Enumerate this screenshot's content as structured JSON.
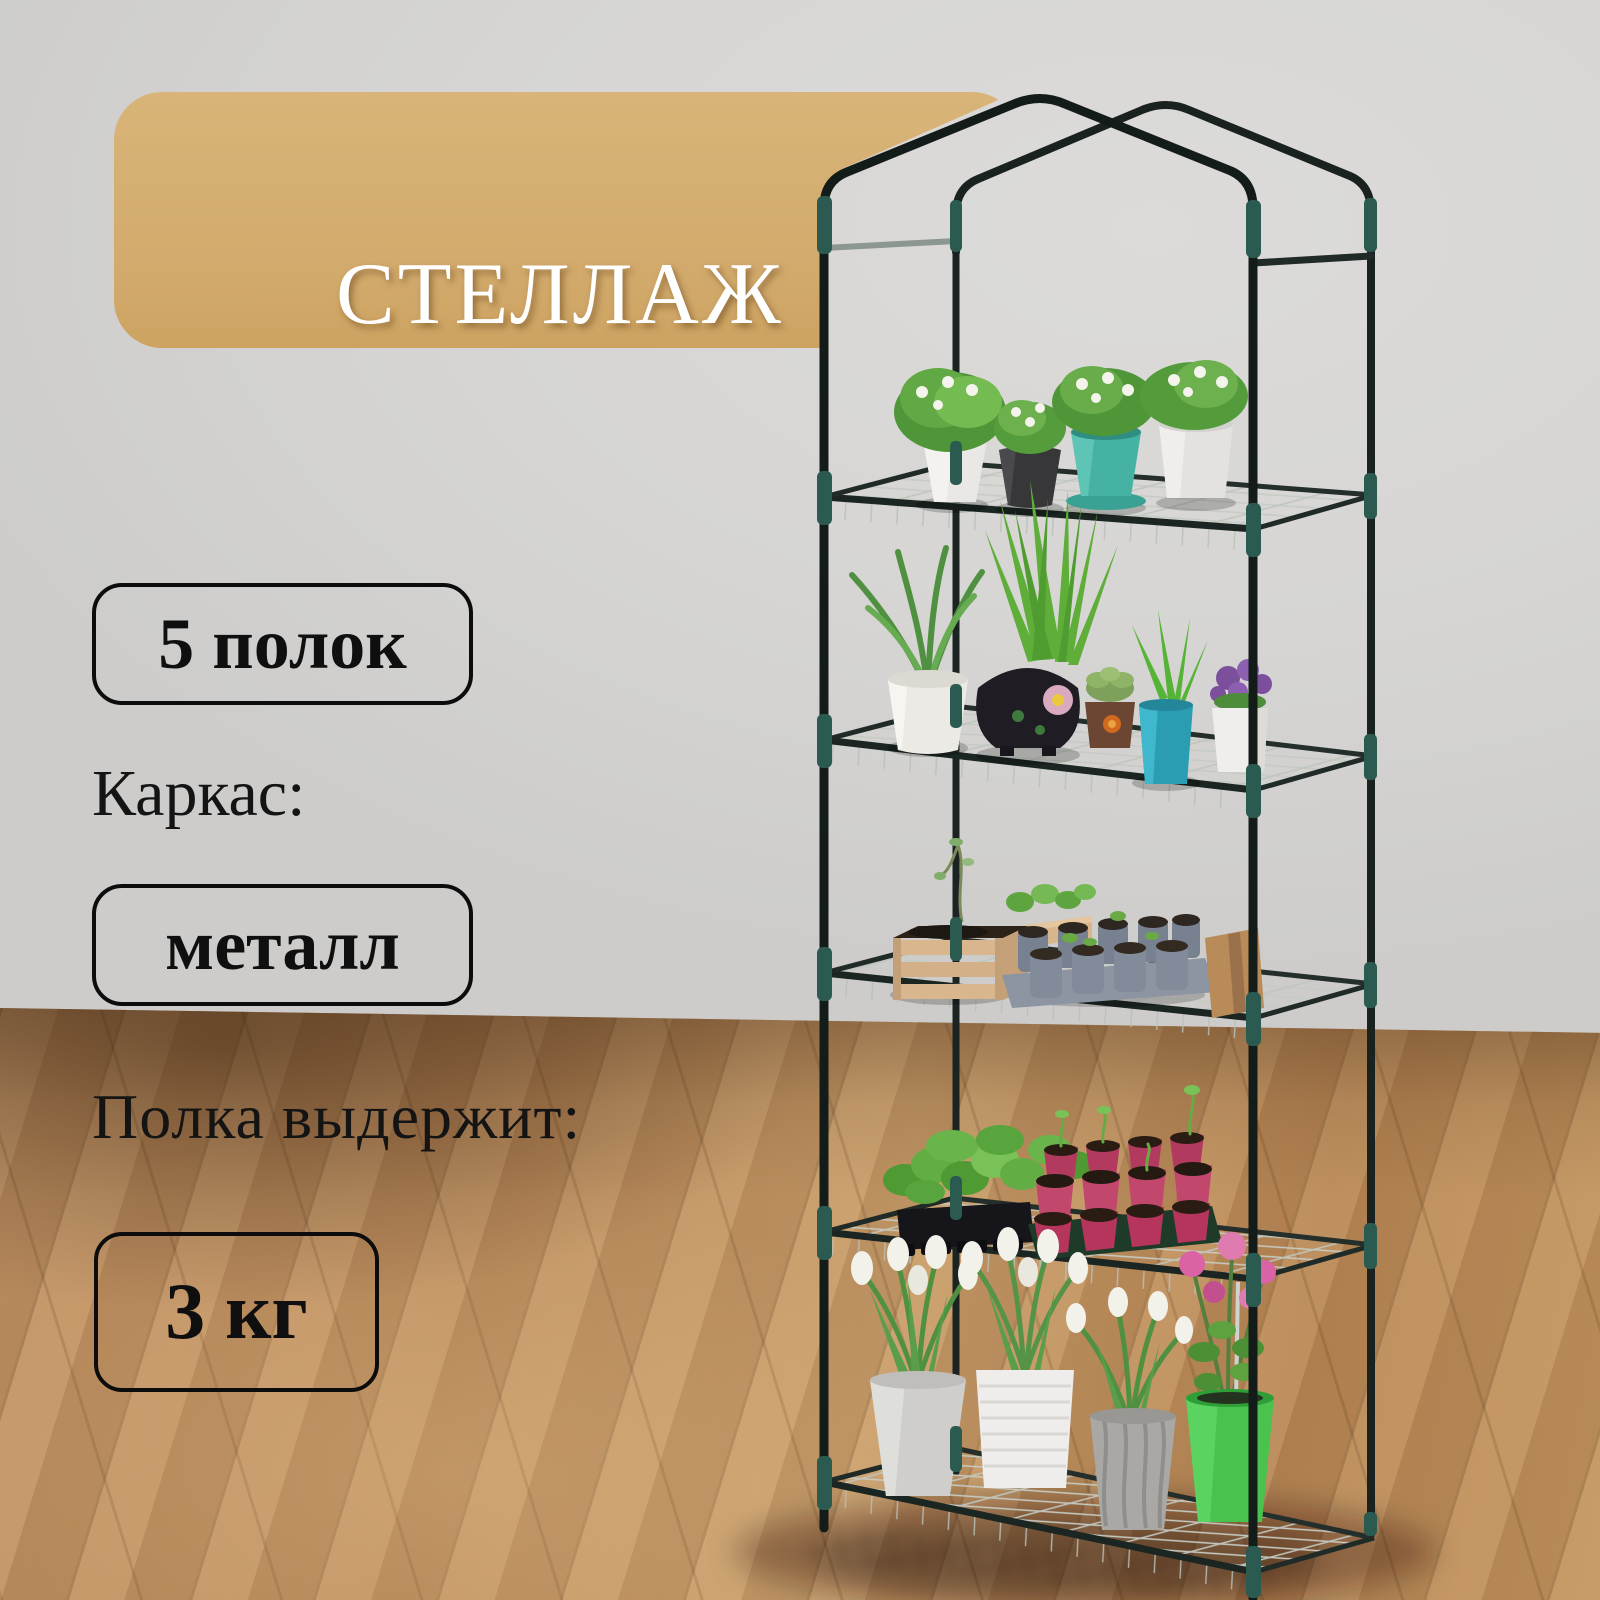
{
  "badge": {
    "title": "СТЕЛЛАЖ",
    "subtitle": "для рассады"
  },
  "specs": {
    "shelves_value": "5 полок",
    "frame_label": "Каркас:",
    "frame_value": "металл",
    "load_label": "Полка выдержит:",
    "load_value": "3 кг"
  },
  "colors": {
    "badge_bg": "#d5ae72",
    "badge_text": "#ffffff",
    "text_dark": "#111111",
    "box_border": "#0c0c0c",
    "wall": "#d6d5d3",
    "floor_wood": "#bd8f5e",
    "frame_tube": "#151d1b",
    "connector_teal": "#2a5a50",
    "mesh_wire": "#c6cbc3",
    "pot_teal": "#45b2a3",
    "pot_cyan": "#2b9db3",
    "pot_green": "#49c24e",
    "tray_pink": "#b23a5f",
    "flower_pink": "#d963a5",
    "flower_purple": "#7b4f9b",
    "foliage_green": "#5aa23e"
  }
}
